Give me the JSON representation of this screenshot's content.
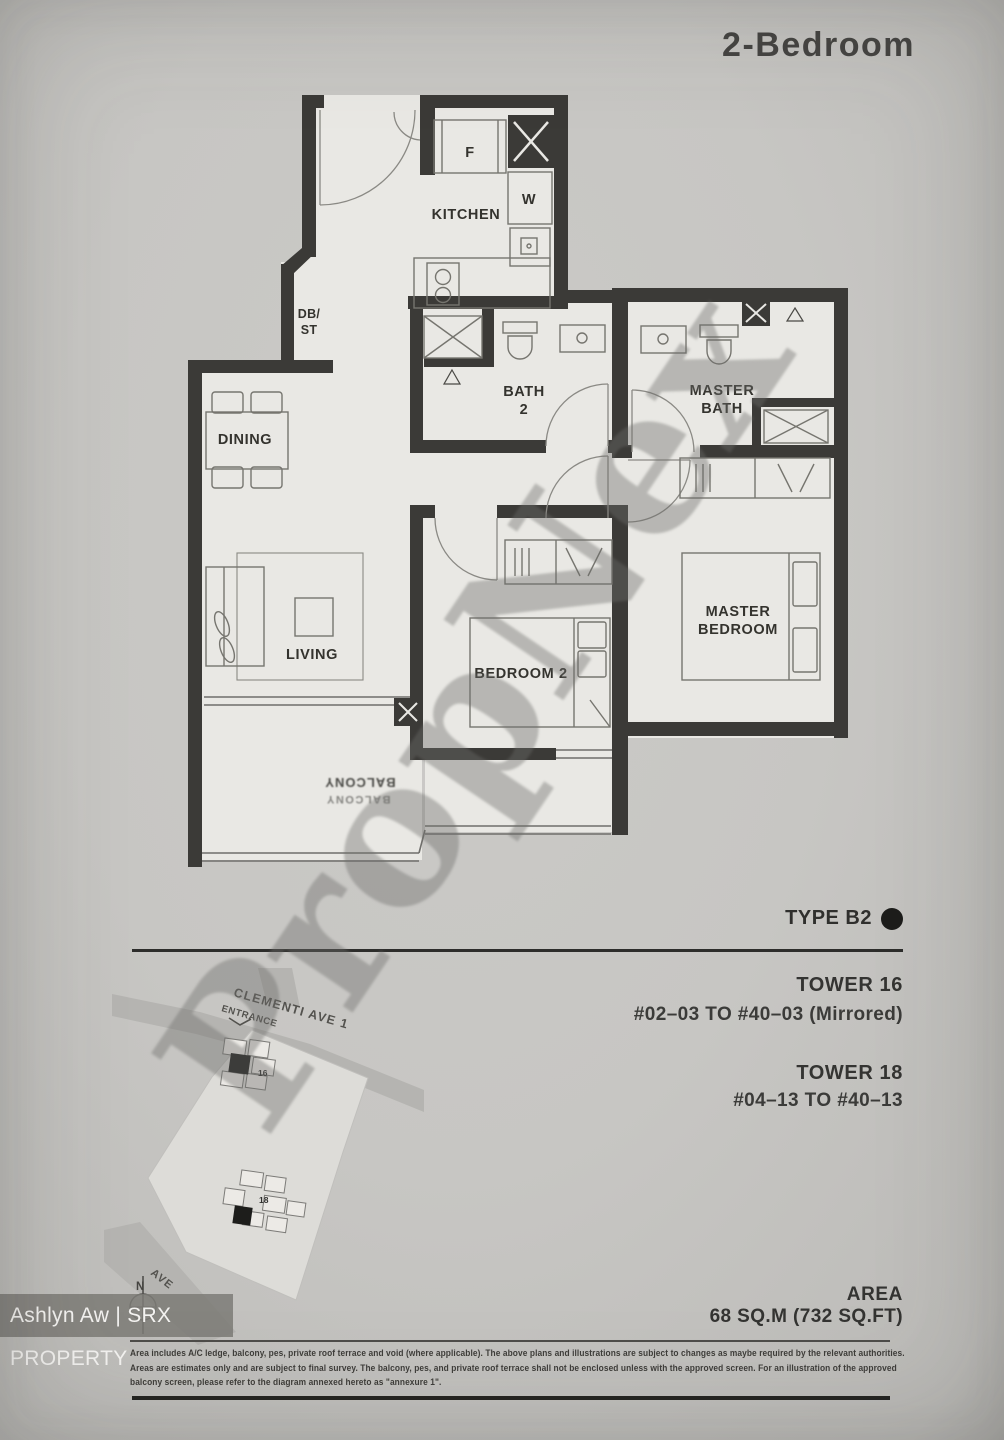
{
  "page": {
    "title": "2-Bedroom",
    "type_label": "TYPE B2",
    "towers": [
      {
        "name": "TOWER 16",
        "units": "#02–03 TO #40–03 (Mirrored)"
      },
      {
        "name": "TOWER 18",
        "units": "#04–13 TO #40–13"
      }
    ],
    "area": {
      "label": "AREA",
      "value": "68 SQ.M (732 SQ.FT)"
    },
    "disclaimer": [
      "Area includes A/C ledge, balcony, pes, private roof terrace and void (where applicable). The above plans and illustrations are subject to changes as maybe required by the relevant authorities.",
      "Areas are estimates only and are subject to final survey. The balcony, pes, and private roof terrace shall not be enclosed unless with the approved screen. For an illustration of the approved",
      "balcony screen, please refer to the diagram annexed hereto as \"annexure 1\"."
    ],
    "watermark": "PropNex",
    "agent_bar": "Ashlyn Aw | SRX PROPERTY"
  },
  "plan": {
    "labels": {
      "kitchen": "KITCHEN",
      "dining": "DINING",
      "living": "LIVING",
      "bedroom2": "BEDROOM 2",
      "master_bedroom": [
        "MASTER",
        "BEDROOM"
      ],
      "master_bath": [
        "MASTER",
        "BATH"
      ],
      "bath2": [
        "BATH",
        "2"
      ],
      "dbst": [
        "DB/",
        "ST"
      ],
      "fridge": "F",
      "washer": "W",
      "balcony": "BALCONY"
    }
  },
  "site_map": {
    "road_main": "CLEMENTI AVE 1",
    "entrance": "ENTRANCE",
    "road_side": "AVE",
    "north": "N",
    "tower16": "16",
    "tower18": "18"
  },
  "colors": {
    "wall": "#3b3a37",
    "paper": "#c7c6c3",
    "floor": "#e9e8e4",
    "ink": "#34332e",
    "type_dot": "#1d1d1b"
  }
}
